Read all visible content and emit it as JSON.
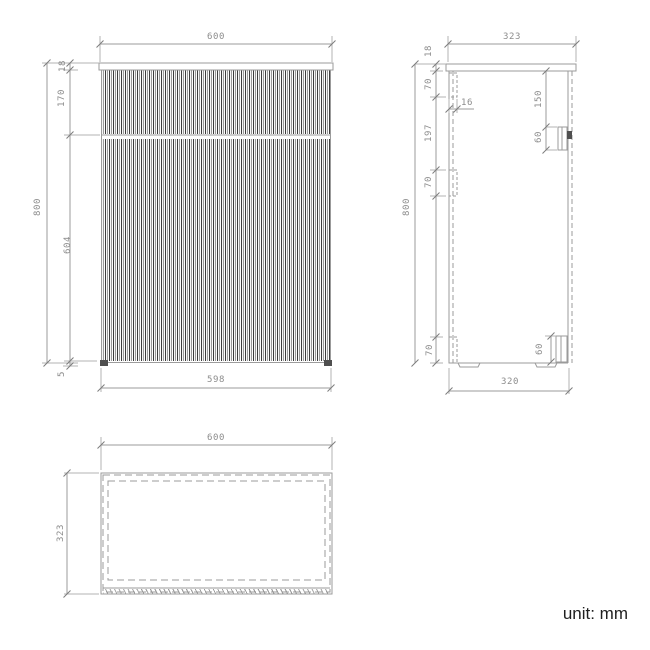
{
  "unit_label": "unit: mm",
  "colors": {
    "line": "#9b9b9b",
    "dim_text": "#8c8c8c",
    "dark_fill": "#4f4f4f"
  },
  "front_view": {
    "top_width": "600",
    "top_thickness": "18",
    "drawer_height": "170",
    "door_height": "604",
    "base_gap": "5",
    "overall_height": "800",
    "bottom_width": "598"
  },
  "side_view": {
    "top_depth": "323",
    "top_thickness": "18",
    "bracket_top_offset": "70",
    "bracket_width": "16",
    "bracket_spacing": "197",
    "bracket_height": "70",
    "handle_top_offset": "150",
    "handle_height": "60",
    "overall_height": "800",
    "bottom_bracket_height": "70",
    "bottom_handle_height": "60",
    "bottom_depth": "320"
  },
  "top_view": {
    "width": "600",
    "depth": "323"
  }
}
